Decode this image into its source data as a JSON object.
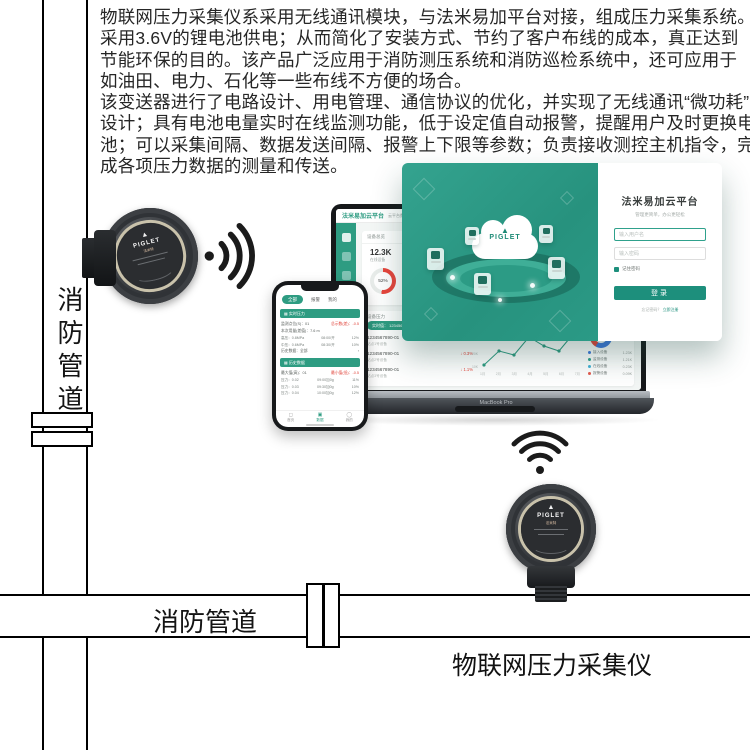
{
  "colors": {
    "teal": "#2E9C82",
    "teal_dark": "#1D8F7C",
    "overlay_bg": "#2FA18C",
    "red": "#E8453C",
    "blue": "#3F7AE0"
  },
  "intro": {
    "p1": [
      "物联网压力采集仪系采用无线通讯模块，与法米易加平台对接，组成压力采集系统。",
      "采用3.6V的锂电池供电；从而简化了安装方式、节约了客户布线的成本，真正达到",
      "节能环保的目的。该产品广泛应用于消防测压系统和消防巡检系统中，还可应用于",
      "如油田、电力、石化等一些布线不方便的场合。"
    ],
    "p2": [
      "该变送器进行了电路设计、用电管理、通信协议的优化，并实现了无线通讯“微功耗”",
      "设计；具有电池电量实时在线监测功能，低于设定值自动报警，提醒用户及时更换电",
      "池；可以采集间隔、数据发送间隔、报警上下限等参数；负责接收测控主机指令，完",
      "成各项压力数据的测量和传送。"
    ]
  },
  "pipes": {
    "vertical_label": "消防管道",
    "horizontal_label": "消防管道"
  },
  "product_label": "物联网压力采集仪",
  "brand": {
    "triangle": "▲",
    "name": "PIGLET",
    "cn": "法米特"
  },
  "cloud_overlay": {
    "cloud_logo_triangle": "▲",
    "cloud_logo_text": "PIGLET",
    "login": {
      "title": "法米易加云平台",
      "subtitle": "管理更简单，办公更轻松",
      "username_placeholder": "输入用户名",
      "password_placeholder": "输入密码",
      "remember_label": "记住密码",
      "login_button": "登录",
      "footer_text": "忘记密码？",
      "footer_link": "立即注册"
    }
  },
  "laptop": {
    "header_title": "法米易加云平台",
    "header_sub": "云平台数据中心",
    "overview_title": "设备总览",
    "stats": [
      {
        "value": "12.3K",
        "label": "在线设备"
      },
      {
        "value": "2.1K",
        "label": "离线设备"
      }
    ],
    "donuts": [
      {
        "pct": 52,
        "label": "52%",
        "color": "#E8453C"
      },
      {
        "pct": 46,
        "label": "46%",
        "color": "#3F7AE0"
      }
    ],
    "bind_title": "绑定设备",
    "list_title": "设备压力",
    "pill": "实时值： 1234567890-01",
    "rows": [
      {
        "id": "1234567890-01",
        "delta": "↑ 0.2%",
        "dir": "up",
        "sub": "站点1号设备"
      },
      {
        "id": "1234567890-01",
        "delta": "↓ 0.3%",
        "dir": "down",
        "sub": "站点2号设备"
      },
      {
        "id": "1234567890-01",
        "delta": "↓ 1.1%",
        "dir": "down",
        "sub": "站点3号设备"
      }
    ],
    "chart": {
      "y_labels": [
        "40K",
        "30K",
        "20K",
        "10K"
      ],
      "x_labels": [
        "1月",
        "2月",
        "3月",
        "4月",
        "5月",
        "6月",
        "7月"
      ],
      "points": [
        [
          4,
          40
        ],
        [
          19,
          26
        ],
        [
          34,
          30
        ],
        [
          49,
          12
        ],
        [
          64,
          21
        ],
        [
          79,
          26
        ],
        [
          94,
          8
        ]
      ]
    },
    "pie_title": "客户占比",
    "pie_value": "1234567890",
    "pie_segments": [
      {
        "color": "#3F7AE0",
        "from": 0,
        "to": 58
      },
      {
        "color": "#E8453C",
        "from": 58,
        "to": 88
      },
      {
        "color": "#2FA18C",
        "from": 88,
        "to": 100
      }
    ],
    "legend": [
      {
        "label": "接入设备",
        "value": "1.23K",
        "color": "#3F7AE0"
      },
      {
        "label": "监测设备",
        "value": "1.21K",
        "color": "#2FA18C"
      },
      {
        "label": "在线设备",
        "value": "0.23K",
        "color": "#45B4D8"
      },
      {
        "label": "报警设备",
        "value": "0.09K",
        "color": "#E45B4F"
      }
    ],
    "brand_label": "MacBook Pro"
  },
  "phone": {
    "tabs": [
      "全部",
      "报警",
      "我的"
    ],
    "section1_title": "▦ 实时压力",
    "s1_rows": [
      [
        "监测点位(S)：01",
        "总示数(差)：-0.5"
      ],
      [
        "本次用量(差值)：7.6 m"
      ],
      [
        "高压：0.8MPa",
        "08:00/开",
        "12%"
      ],
      [
        "中压：0.6MPa",
        "08:30/开",
        "10%"
      ],
      [
        "历史数据：全部",
        "›"
      ]
    ],
    "section2_title": "▦ 历史数据",
    "s2_rows": [
      [
        "最大值(高)：01",
        "最小值(低)：-0.5"
      ],
      [
        "压力：0.02",
        "09:00加0g",
        "11%"
      ],
      [
        "压力：0.03",
        "09:30加0g",
        "10%"
      ],
      [
        "压力：0.04",
        "10:00加0g",
        "12%"
      ]
    ],
    "nav": [
      {
        "icon": "◻",
        "label": "首页"
      },
      {
        "icon": "▣",
        "label": "数据"
      },
      {
        "icon": "◯",
        "label": "我的"
      }
    ]
  }
}
